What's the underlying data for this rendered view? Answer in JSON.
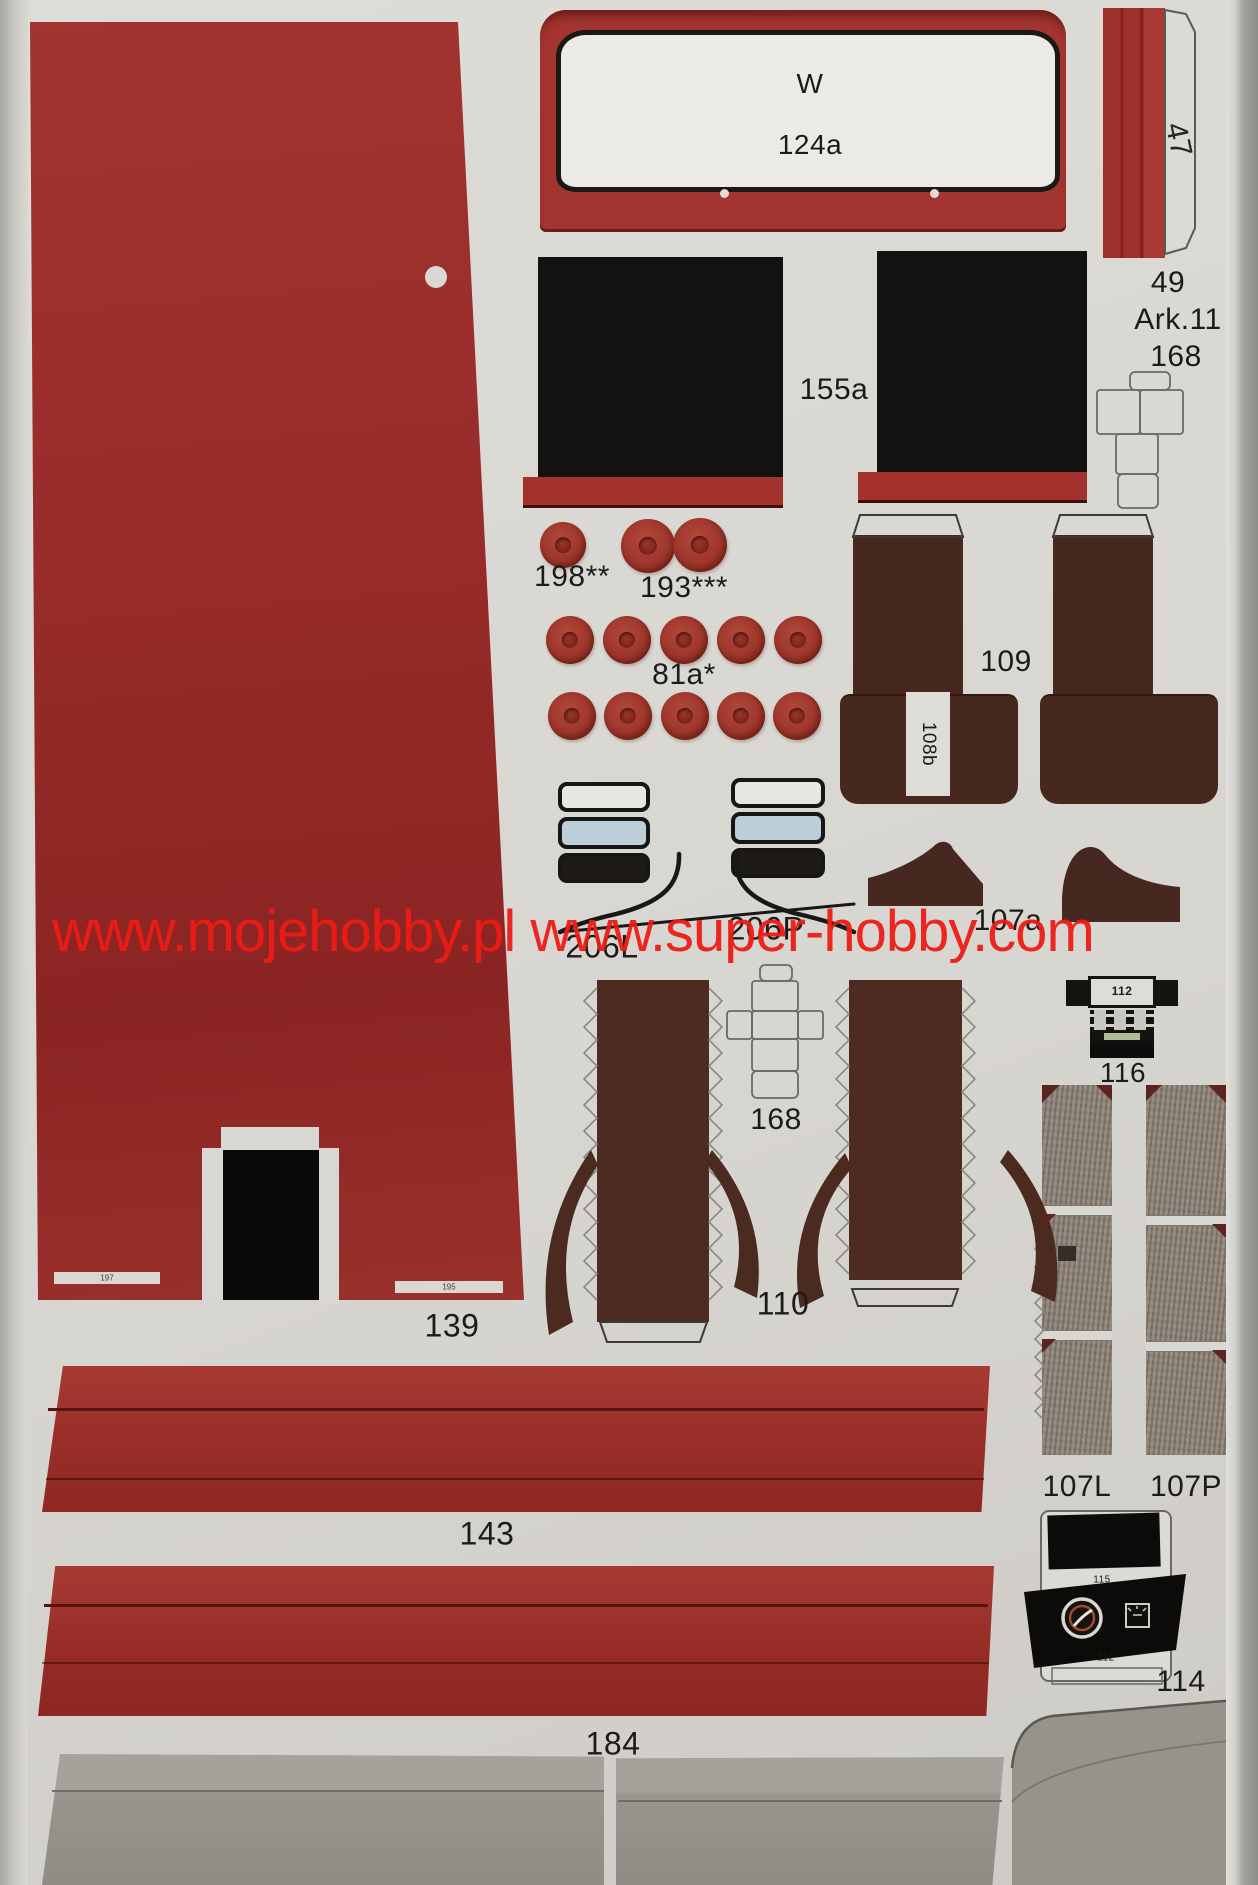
{
  "watermark": "www.mojehobby.pl www.super-hobby.com",
  "sheet": {
    "number": "49",
    "arkusz": "Ark.11",
    "net_part": "168"
  },
  "labels": {
    "w": "W",
    "windshield": "124a",
    "side_strip": "47",
    "mat": "155a",
    "disc_single": "198**",
    "disc_pair": "193***",
    "disc_set": "81a*",
    "seats": "109",
    "belt": "108b",
    "arch": "107a",
    "glass_left": "206L",
    "glass_right": "206P",
    "box_net": "168",
    "radio": "116",
    "radio_face": "112",
    "engine": "110",
    "cab_panel": "139",
    "mark_left": "197",
    "mark_right": "195",
    "tarp_top": "143",
    "tarp_bottom": "184",
    "plank_left": "107L",
    "plank_right": "107P",
    "dash": "114",
    "dash_upper": "115",
    "dash_lower": "112"
  },
  "colors": {
    "paper": "#d9d7d2",
    "part_red": "#9e2f2a",
    "dark_red": "#8a2521",
    "seat_brown": "#46281e",
    "mat_black": "#131110",
    "glass_blue": "#bccfd8",
    "watermark_red": "#ee1c15",
    "tarp_grey": "#98958e"
  }
}
